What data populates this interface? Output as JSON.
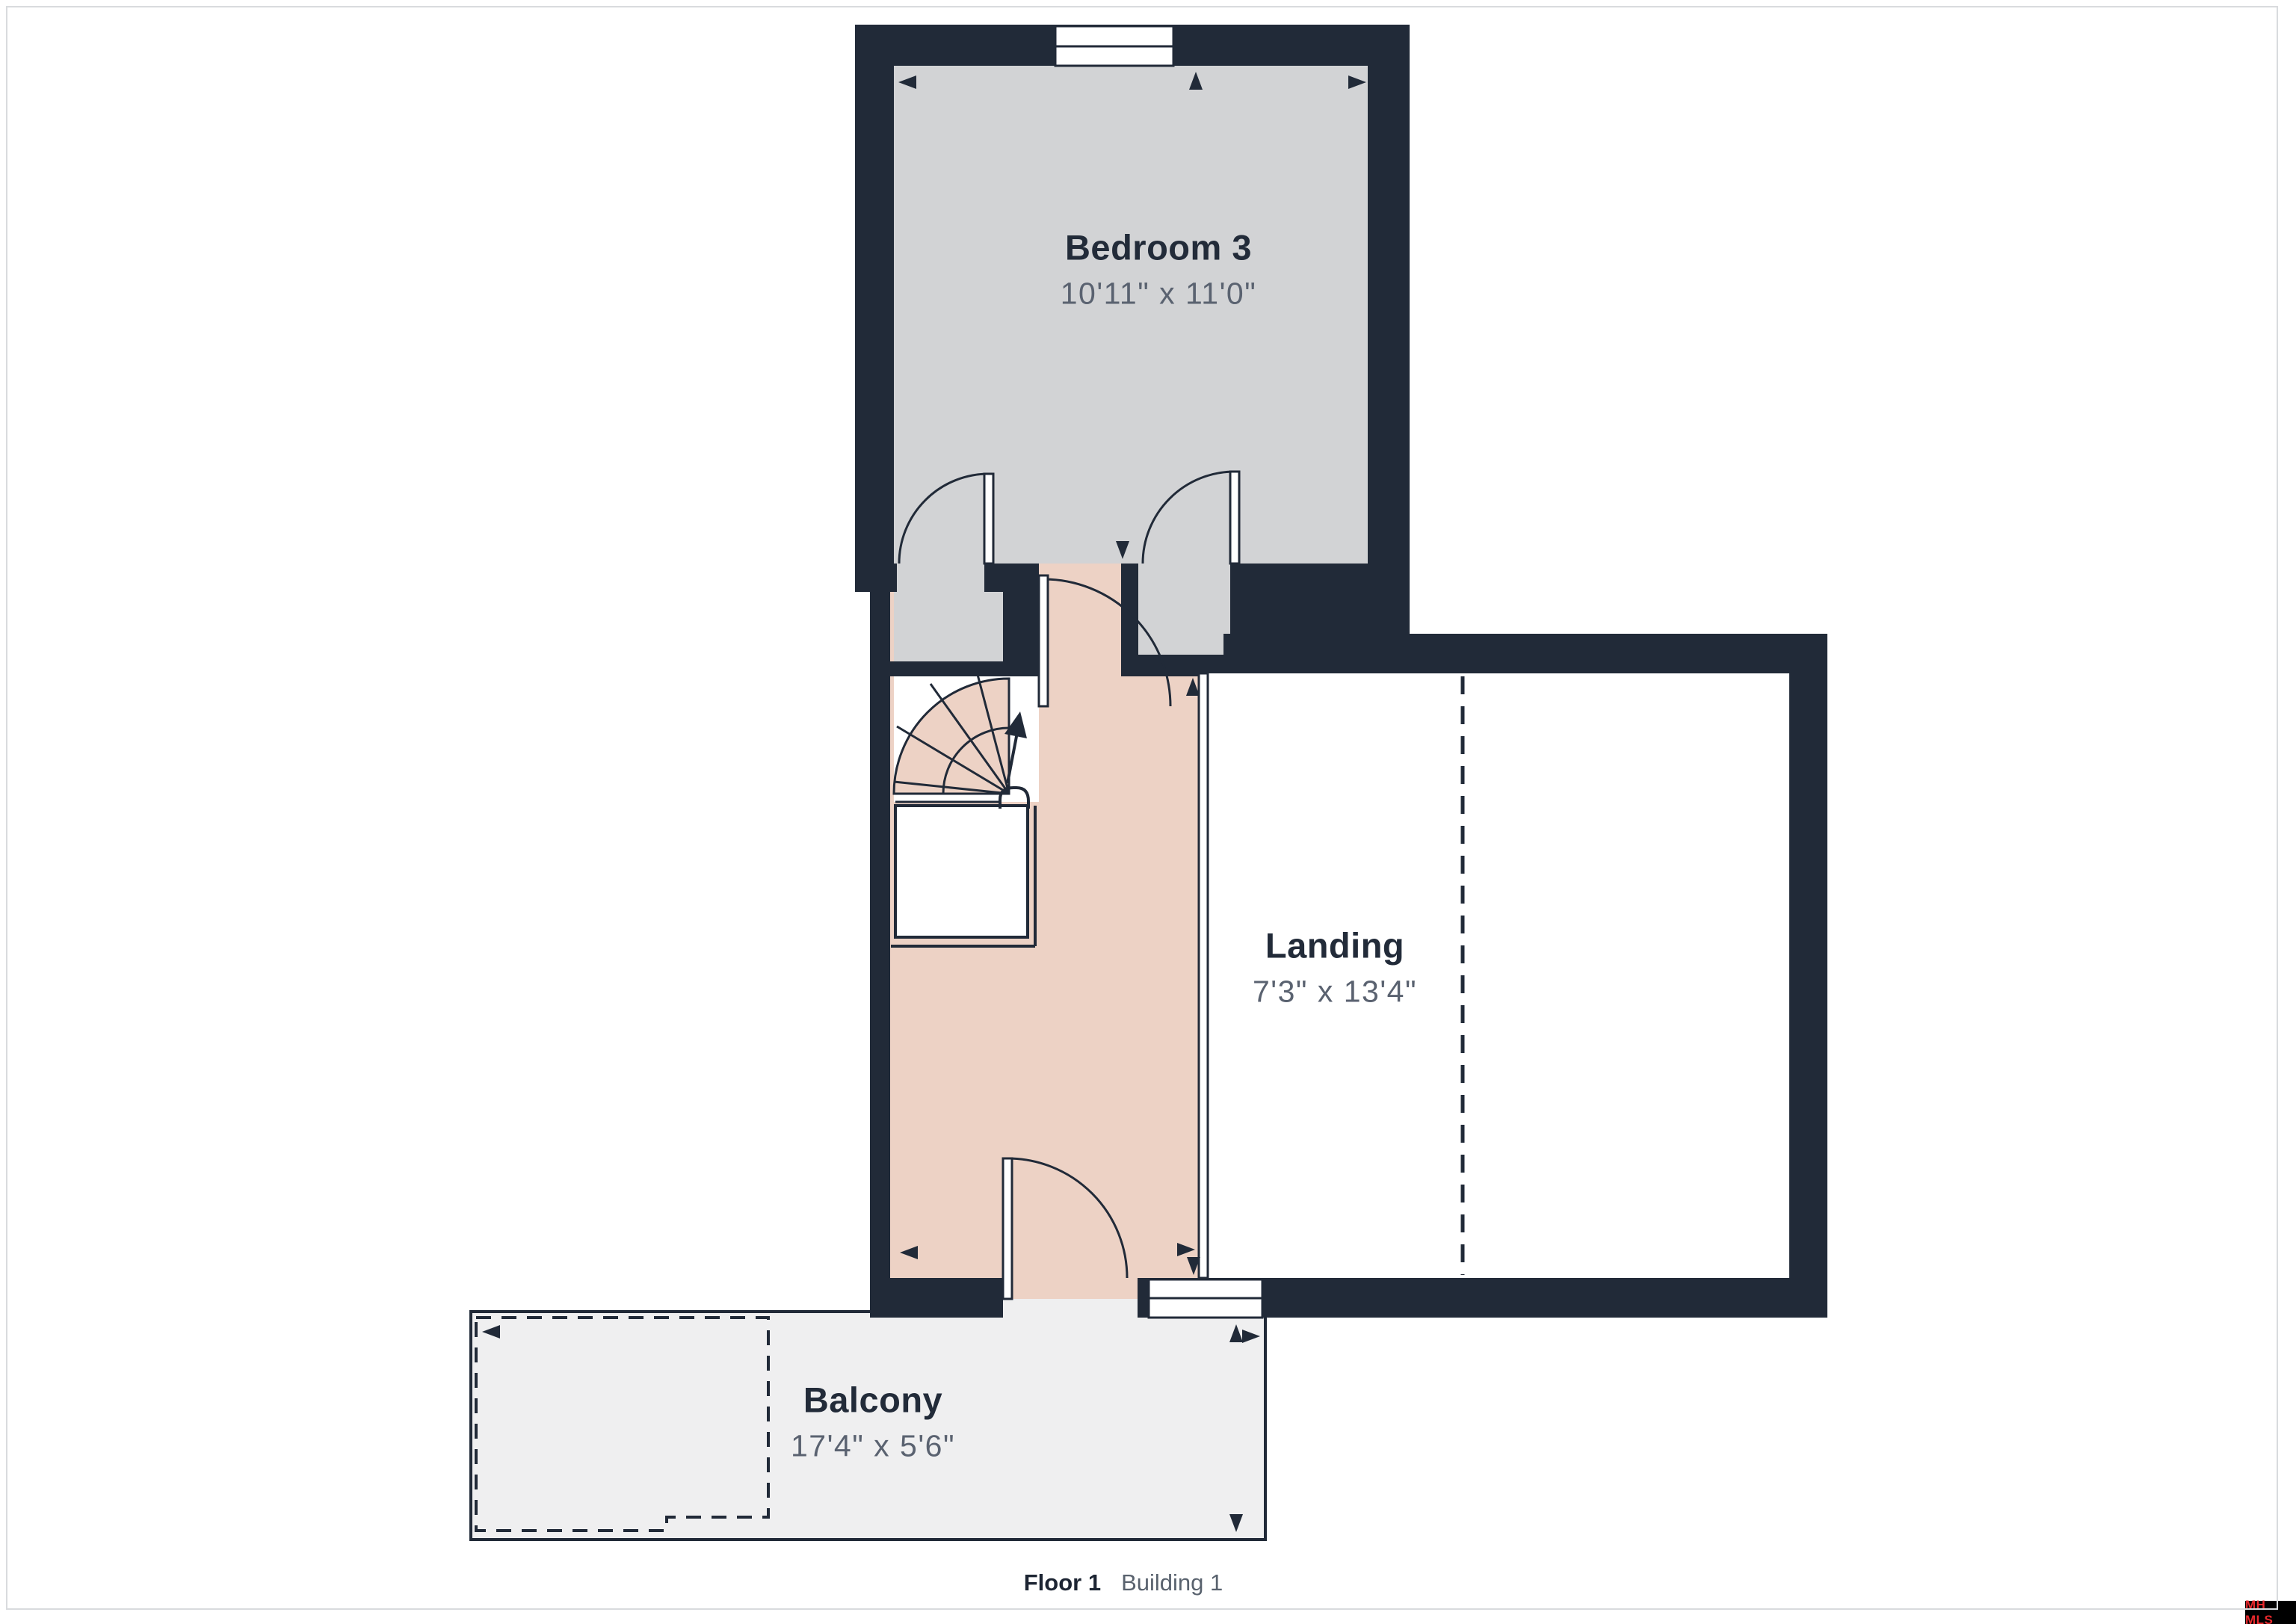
{
  "floorplan": {
    "rooms": [
      {
        "id": "bedroom-3",
        "name": "Bedroom 3",
        "dimensions": "10'11\" x 11'0\""
      },
      {
        "id": "landing",
        "name": "Landing",
        "dimensions": "7'3\" x 13'4\""
      },
      {
        "id": "balcony",
        "name": "Balcony",
        "dimensions": "17'4\" x 5'6\""
      }
    ],
    "colors": {
      "wall": "#212a38",
      "bedroom_fill": "#d2d3d5",
      "hall_fill": "#edd2c5",
      "balcony_fill": "#efeff0",
      "landing_fill": "#ffffff",
      "room_name_text": "#222b39",
      "dimension_text": "#5a6270",
      "page_border": "#d9dbde"
    }
  },
  "footer": {
    "floor_label": "Floor 1",
    "building_label": "Building 1"
  },
  "watermark": {
    "text": "MH MLS",
    "background": "#000000",
    "text_color": "#e8282c"
  }
}
